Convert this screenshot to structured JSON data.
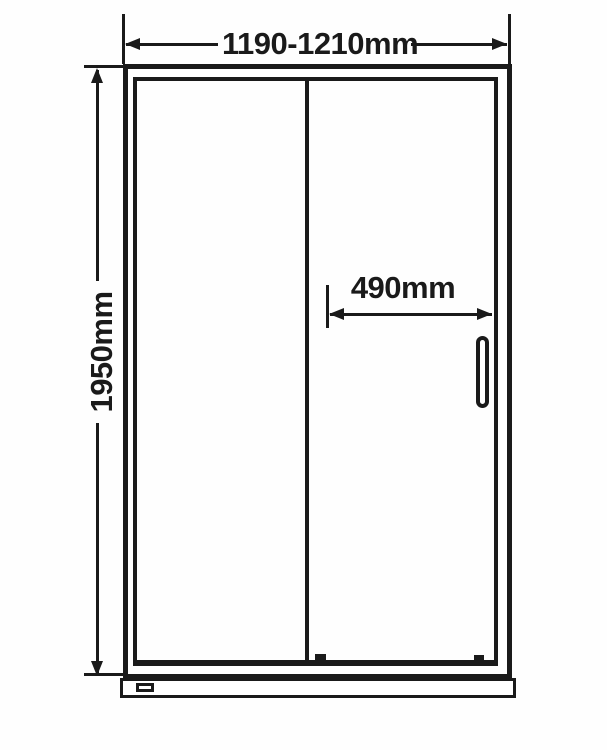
{
  "colors": {
    "ink": "#1a1a1a",
    "background": "#fefefe"
  },
  "dimensions": {
    "width": {
      "label": "1190-1210mm"
    },
    "height": {
      "label": "1950mm"
    },
    "handle_offset": {
      "label": "490mm"
    }
  }
}
